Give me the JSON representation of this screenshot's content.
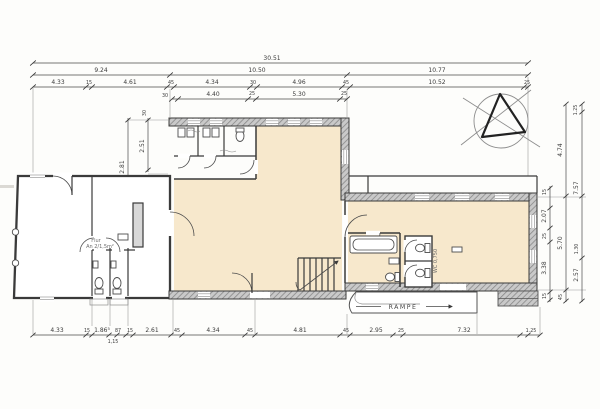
{
  "drawing": {
    "type": "architectural-floor-plan-scan",
    "colors": {
      "paper": "#fdfdfb",
      "ink": "#3a3a3a",
      "room_fill": "#f7e8cc",
      "dim_ink": "#444444"
    }
  },
  "dims": {
    "top_row1": [
      "30.51"
    ],
    "top_row2": [
      "9.24",
      "10.50",
      "10.77"
    ],
    "top_row3": [
      "4.33",
      "15",
      "4.61",
      "45",
      "4.34",
      "30",
      "4.96",
      "45",
      "10.52",
      "25"
    ],
    "top_row4": [
      "30",
      "4.40",
      "25",
      "5.30",
      "25"
    ],
    "left_col": [
      "2.81",
      "2.51",
      "30"
    ],
    "right_col": [
      "1.25",
      "4.74",
      "7.57",
      "15",
      "2.07",
      "25",
      "5.70",
      "1.30",
      "3.38",
      "2.57",
      "15",
      "45"
    ],
    "bottom_row": [
      "4.33",
      "15",
      "1.86⁵",
      "87",
      "15",
      "2.61",
      "45",
      "4.34",
      "45",
      "4.81",
      "45",
      "2.95",
      "25",
      "7.32",
      "1.25"
    ],
    "bottom_sub": "1,15"
  },
  "labels": {
    "rampe": "RAMPE",
    "wc_right": "WC 0,750",
    "flur_1": "Flur",
    "flur_2": "An 2/1,5m²"
  }
}
